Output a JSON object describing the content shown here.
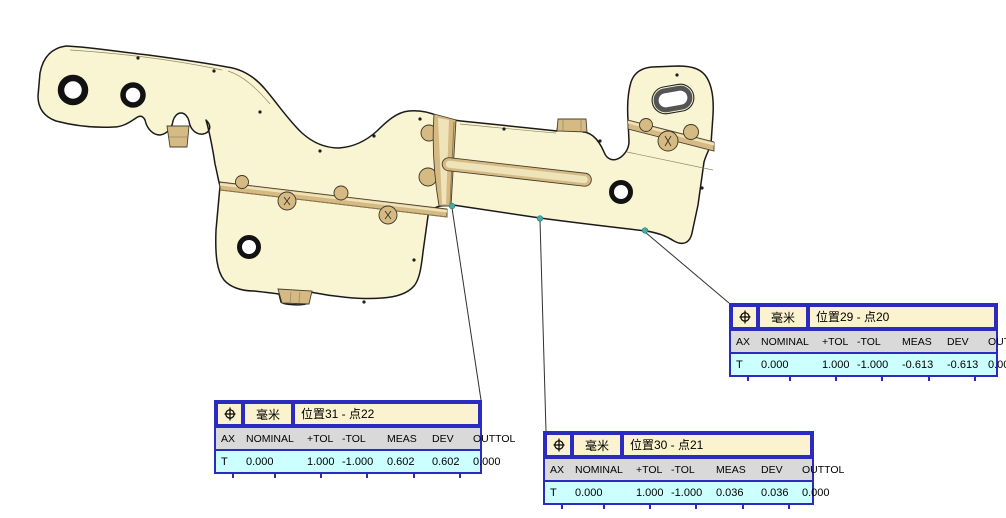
{
  "view": {
    "type": "cmm-graphics-window",
    "measure_point_count": 3
  },
  "colors": {
    "part_fill": "#F9F5D2",
    "part_outline": "#1A1A1A",
    "bead_fill": "#D6BA84",
    "bead_light": "#EFE3B9",
    "bead_dark": "#8F7748",
    "label_border": "#2B2BC0",
    "label_header_bg": "#FBF3CF",
    "label_colhead_bg": "#D9D9D9",
    "label_data_bg": "#CCFFFF",
    "label_text": "#000000",
    "measure_point": "#4AA9A9",
    "leader_line": "#303030",
    "background": "#FFFFFF"
  },
  "labels": [
    {
      "id": "29",
      "symbol": "true-position",
      "unit": "毫米",
      "title": "位置29 - 点20",
      "columns": [
        "AX",
        "NOMINAL",
        "+TOL",
        "-TOL",
        "MEAS",
        "DEV",
        "OUTTOL"
      ],
      "values": [
        "T",
        "0.000",
        "1.000",
        "-1.000",
        "-0.613",
        "-0.613",
        "0.000"
      ]
    },
    {
      "id": "31",
      "symbol": "true-position",
      "unit": "毫米",
      "title": "位置31 - 点22",
      "columns": [
        "AX",
        "NOMINAL",
        "+TOL",
        "-TOL",
        "MEAS",
        "DEV",
        "OUTTOL"
      ],
      "values": [
        "T",
        "0.000",
        "1.000",
        "-1.000",
        "0.602",
        "0.602",
        "0.000"
      ]
    },
    {
      "id": "30",
      "symbol": "true-position",
      "unit": "毫米",
      "title": "位置30 - 点21",
      "columns": [
        "AX",
        "NOMINAL",
        "+TOL",
        "-TOL",
        "MEAS",
        "DEV",
        "OUTTOL"
      ],
      "values": [
        "T",
        "0.000",
        "1.000",
        "-1.000",
        "0.036",
        "0.036",
        "0.000"
      ]
    }
  ]
}
